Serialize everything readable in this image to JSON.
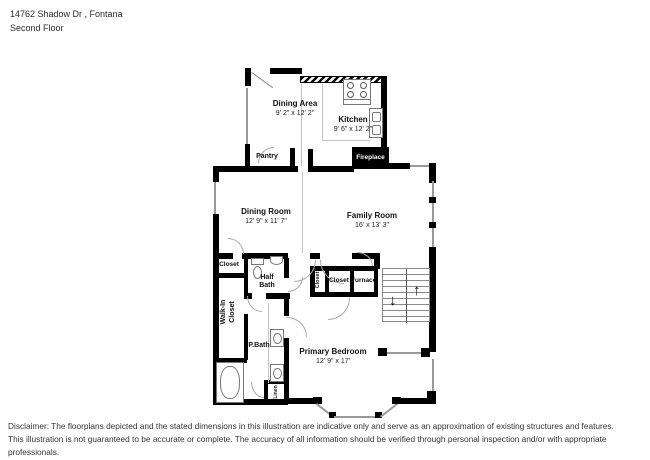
{
  "header": {
    "address": "14762 Shadow Dr , Fontana",
    "floor": "Second Floor"
  },
  "rooms": {
    "dining_area": {
      "name": "Dining Area",
      "dims": "9' 2\" x 12' 2\""
    },
    "kitchen": {
      "name": "Kitchen",
      "dims": "9' 6\" x 12' 2\""
    },
    "pantry": {
      "name": "Pantry"
    },
    "fireplace": {
      "name": "Fireplace"
    },
    "dining_room": {
      "name": "Dining Room",
      "dims": "12' 9\" x 11' 7\""
    },
    "family_room": {
      "name": "Family Room",
      "dims": "16' x 13' 3\""
    },
    "closet_upper": {
      "name": "Closet"
    },
    "half_bath": {
      "name": "Half Bath"
    },
    "walk_in_closet": {
      "name": "Walk-In Closet"
    },
    "p_bath": {
      "name": "P.Bath"
    },
    "closet_small": {
      "name": "Closet"
    },
    "closet_bedroom": {
      "name": "Closet"
    },
    "furnace": {
      "name": "Furnace"
    },
    "linen": {
      "name": "Linen"
    },
    "primary_bedroom": {
      "name": "Primary Bedroom",
      "dims": "12' 9\" x 17'"
    }
  },
  "stairs": {
    "down_arrow": "↓",
    "up_arrow": "↑"
  },
  "disclaimer": {
    "line1": "Disclaimer: The floorplans depicted and the stated dimensions in this illustration are indicative only and serve as an approximation of existing structures and features.",
    "line2": "This illustration is not guaranteed to be accurate or complete. The accuracy of all information should be verified through personal inspection and/or with appropriate professionals."
  },
  "colors": {
    "wall": "#000000",
    "window_line": "#9a9a9a",
    "fixture_outline": "#777777",
    "text": "#111111"
  }
}
